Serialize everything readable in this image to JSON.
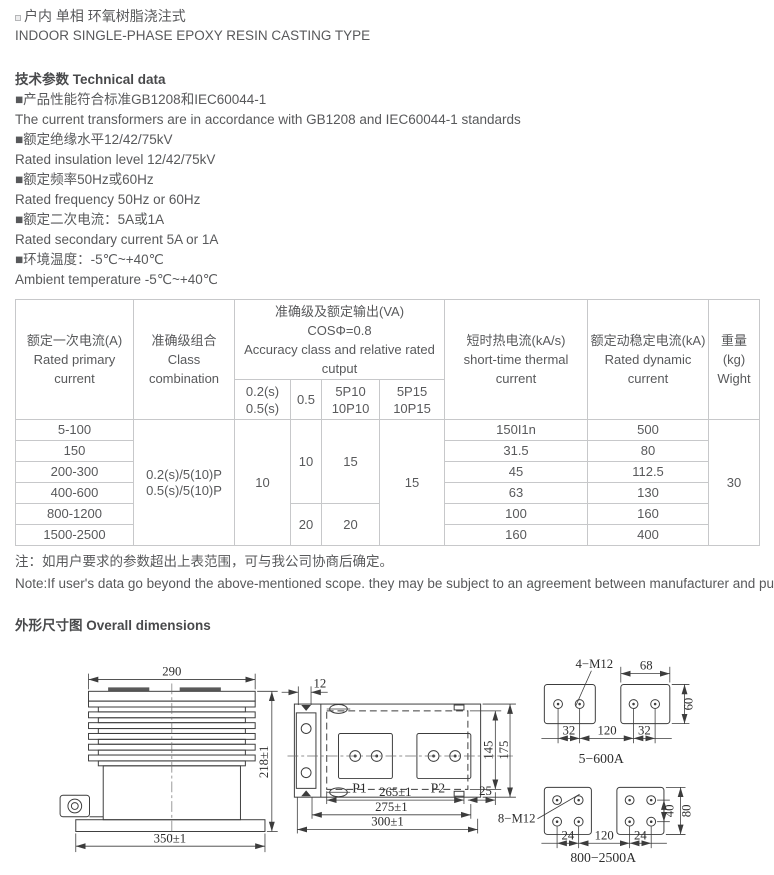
{
  "header": {
    "title_zh": "户内 单相 环氧树脂浇注式",
    "title_en": "INDOOR SINGLE-PHASE EPOXY RESIN CASTING TYPE"
  },
  "technical": {
    "heading": "技术参数 Technical data",
    "items": [
      {
        "zh": "■产品性能符合标准GB1208和IEC60044-1",
        "en": "The current transformers are in accordance with GB1208 and IEC60044-1 standards"
      },
      {
        "zh": "■额定绝缘水平12/42/75kV",
        "en": "Rated insulation level 12/42/75kV"
      },
      {
        "zh": "■额定频率50Hz或60Hz",
        "en": "Rated frequency 50Hz or 60Hz"
      },
      {
        "zh": "■额定二次电流：5A或1A",
        "en": "Rated secondary current 5A or 1A"
      },
      {
        "zh": "■环境温度：-5℃~+40℃",
        "en": "Ambient temperature -5℃~+40℃"
      }
    ]
  },
  "table": {
    "header": {
      "primary": [
        "额定一次电流(A)",
        "Rated primary",
        "current"
      ],
      "class_combo": [
        "准确级组合",
        "Class",
        "combination"
      ],
      "accuracy_group": [
        "准确级及额定输出(VA)",
        "COSΦ=0.8",
        "Accuracy class and relative rated",
        "cutput"
      ],
      "sub_0_2s": [
        "0.2(s)",
        "0.5(s)"
      ],
      "sub_0_5": "0.5",
      "sub_5p10": [
        "5P10",
        "10P10"
      ],
      "sub_5p15": [
        "5P15",
        "10P15"
      ],
      "thermal": [
        "短时热电流(kA/s)",
        "short-time thermal",
        "current"
      ],
      "dynamic": [
        "额定动稳定电流(kA)",
        "Rated dynamic",
        "current"
      ],
      "weight": [
        "重量(kg)",
        "Wight"
      ]
    },
    "merged": {
      "class_combo": [
        "0.2(s)/5(10)P",
        "0.5(s)/5(10)P"
      ],
      "acc_0_2s": "10",
      "acc_0_5_top": "10",
      "acc_0_5_bottom": "20",
      "acc_5p10_top": "15",
      "acc_5p10_bottom": "20",
      "acc_5p15": "15",
      "weight": "30"
    },
    "rows": [
      {
        "primary": "5-100",
        "thermal": "150I1n",
        "dynamic": "500"
      },
      {
        "primary": "150",
        "thermal": "31.5",
        "dynamic": "80"
      },
      {
        "primary": "200-300",
        "thermal": "45",
        "dynamic": "112.5"
      },
      {
        "primary": "400-600",
        "thermal": "63",
        "dynamic": "130"
      },
      {
        "primary": "800-1200",
        "thermal": "100",
        "dynamic": "160"
      },
      {
        "primary": "1500-2500",
        "thermal": "160",
        "dynamic": "400"
      }
    ]
  },
  "note": {
    "zh": "注：如用户要求的参数超出上表范围，可与我公司协商后确定。",
    "en": "Note:If user's data go beyond the above-mentioned scope. they may be subject to an agreement between manufacturer and purchaser."
  },
  "dimensions": {
    "heading": "外形尺寸图 Overall dimensions",
    "side_view": {
      "top_width": "290",
      "height": "218±1",
      "bottom_width": "350±1"
    },
    "top_view": {
      "offset": "12",
      "terminal1": "P1",
      "terminal2": "P2",
      "inner_height": "145",
      "outer_height": "175",
      "span_inner": "265±1",
      "span_mid": "275±1",
      "span_outer": "300±1",
      "edge_offset": "25"
    },
    "pads_small": {
      "bolts": "4−M12",
      "pad_width": "68",
      "pad_height": "60",
      "hole_span_left": "32",
      "center_span": "120",
      "hole_span_right": "32",
      "caption": "5−600A"
    },
    "pads_large": {
      "bolts": "8−M12",
      "hole_rows": "40",
      "pad_height": "80",
      "hole_span_left": "24",
      "center_span": "120",
      "hole_span_right": "24",
      "caption": "800−2500A"
    }
  }
}
